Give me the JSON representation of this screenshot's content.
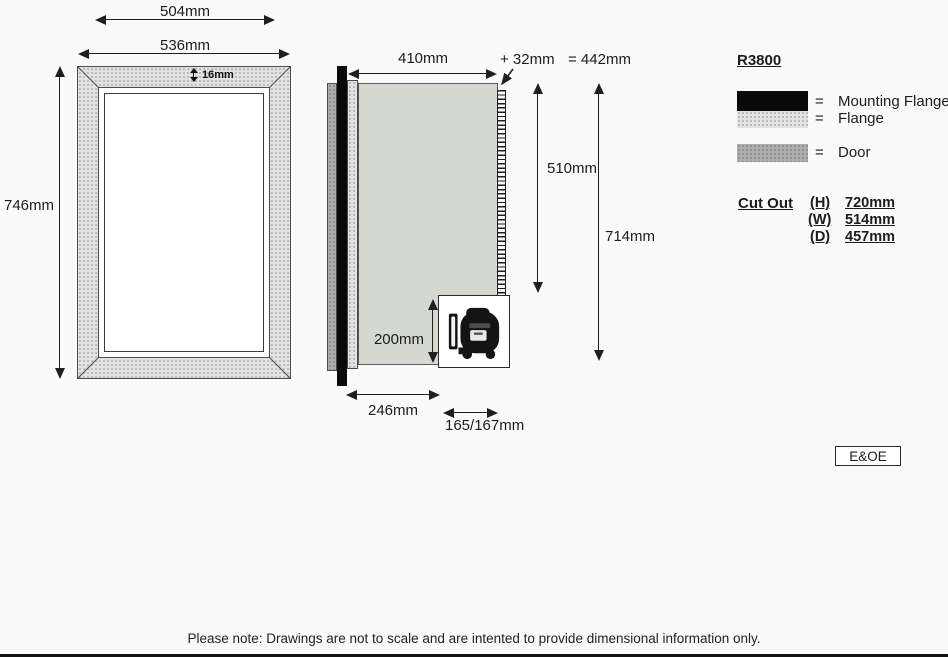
{
  "front_view": {
    "width_inner": "504mm",
    "width_outer": "536mm",
    "height": "746mm",
    "flange_thickness": "16mm"
  },
  "side_view": {
    "depth_body": "410mm",
    "depth_extra": "+ 32mm",
    "depth_total": "= 442mm",
    "height_coil": "510mm",
    "height_total": "714mm",
    "compressor_height": "200mm",
    "depth_front": "246mm",
    "compressor_depth": "165/167mm"
  },
  "legend": {
    "model": "R3800",
    "items": [
      {
        "eq": "=",
        "label": "Mounting Flange"
      },
      {
        "eq": "=",
        "label": "Flange"
      },
      {
        "eq": "=",
        "label": "Door"
      }
    ],
    "cut_out": {
      "title": "Cut Out",
      "rows": [
        {
          "key": "(H)",
          "value": "720mm"
        },
        {
          "key": "(W)",
          "value": "514mm"
        },
        {
          "key": "(D)",
          "value": "457mm"
        }
      ]
    },
    "eoe": "E&OE"
  },
  "footer": {
    "note": "Please note: Drawings are not to scale and are intented to provide dimensional information only."
  },
  "colors": {
    "mounting_flange": "#0a0a0a",
    "flange": "#e2e2e2",
    "door": "#aeaeae",
    "cabinet_body": "#d5d7d1",
    "line": "#1f1f1f",
    "background": "#fafafa"
  }
}
